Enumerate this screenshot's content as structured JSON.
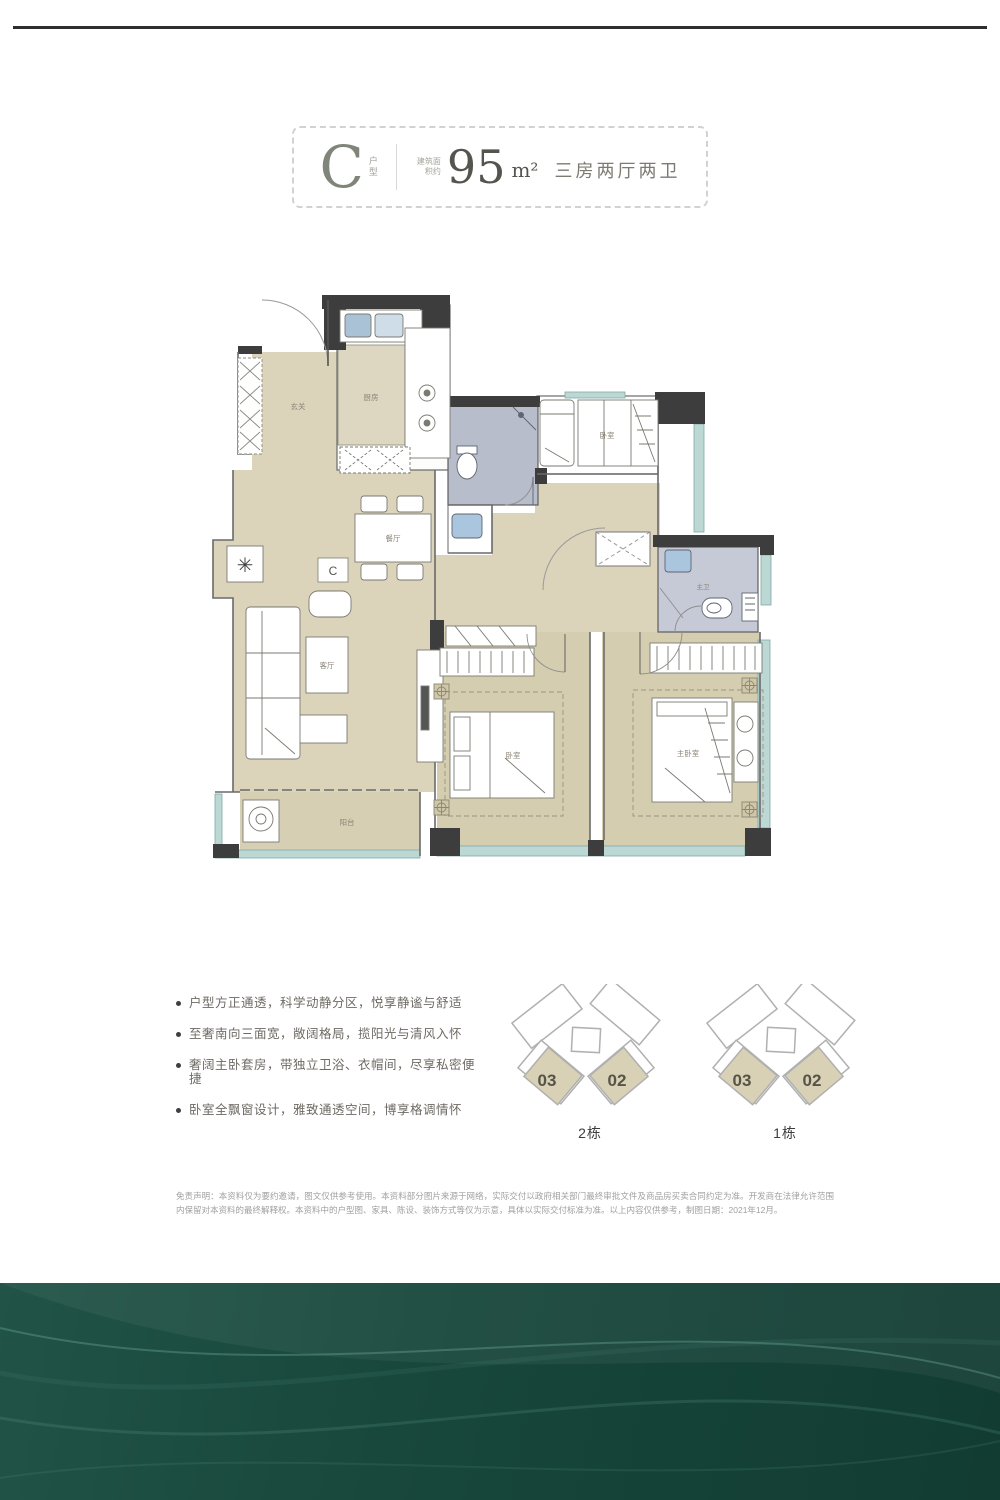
{
  "title_box": {
    "type_letter": "C",
    "type_label": "户型",
    "area_prefix": "建筑面积约",
    "area_value": "95",
    "area_unit": "m²",
    "layout": "三房两厅两卫"
  },
  "floorplan": {
    "labels": {
      "foyer": "玄关",
      "kitchen": "厨房",
      "dining": "餐厅",
      "living": "客厅",
      "balcony": "阳台",
      "bedroom_top": "卧室",
      "bedroom_mid": "卧室",
      "master_bedroom": "主卧室",
      "master_bath": "主卫",
      "unit_marker": "C"
    }
  },
  "features": [
    "户型方正通透，科学动静分区，悦享静谧与舒适",
    "至奢南向三面宽，敞阔格局，揽阳光与清风入怀",
    "奢阔主卧套房，带独立卫浴、衣帽间，尽享私密便捷",
    "卧室全飘窗设计，雅致通透空间，博享格调情怀"
  ],
  "keyplans": [
    {
      "unit_left": "03",
      "unit_right": "02",
      "caption": "2栋"
    },
    {
      "unit_left": "03",
      "unit_right": "02",
      "caption": "1栋"
    }
  ],
  "disclaimer": "免责声明：本资料仅为要约邀请，图文仅供参考使用。本资料部分图片来源于网络，实际交付以政府相关部门最终审批文件及商品房买卖合同约定为准。开发商在法律允许范围内保留对本资料的最终解释权。本资料中的户型图、家具、陈设、装饰方式等仅为示意，具体以实际交付标准为准。以上内容仅供参考，制图日期：2021年12月。",
  "colors": {
    "footer_green": "#1d4a3d",
    "floor_tan": "#dbd3ba",
    "wall_dark": "#3d3d3d",
    "window_blue": "#bcd8d5",
    "fixture_blue": "#a9c6de",
    "keyplan_tan": "#d8d1b5"
  }
}
